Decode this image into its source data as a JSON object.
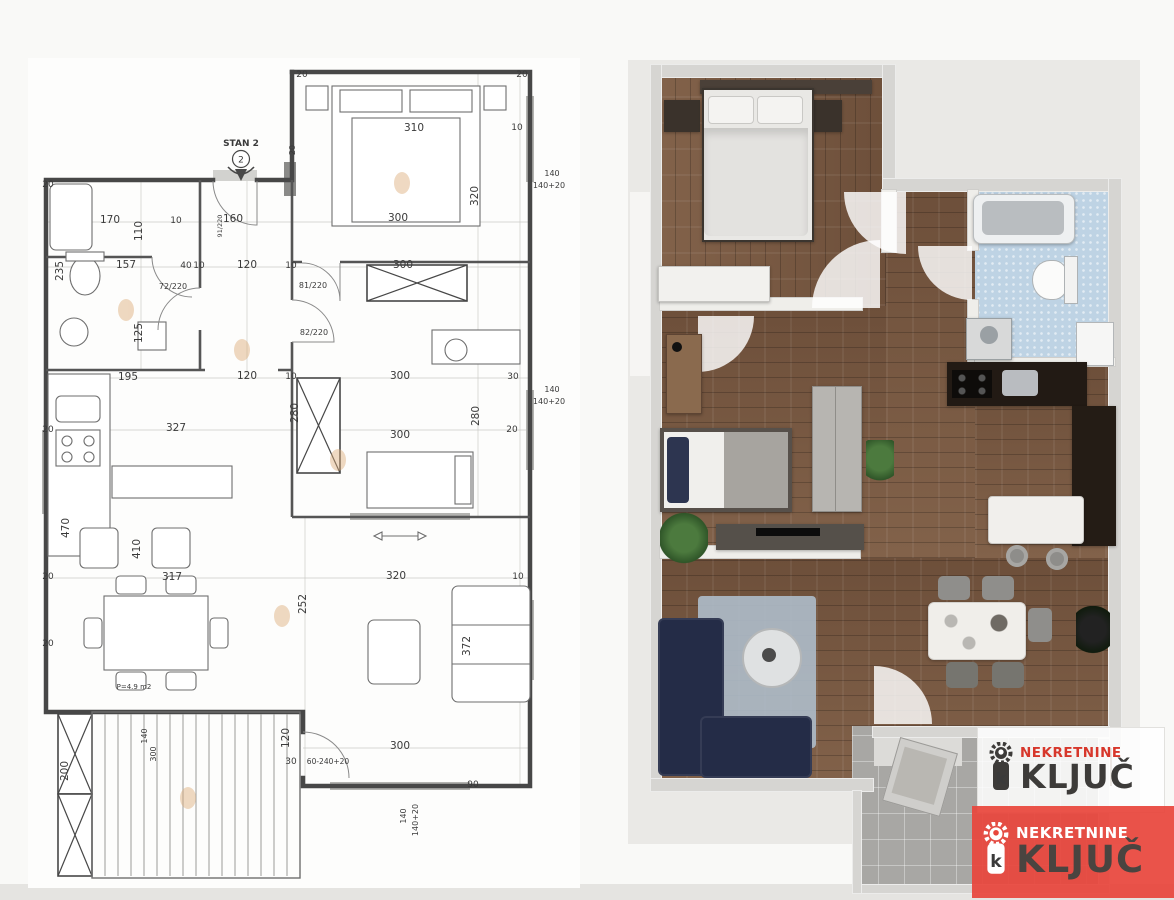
{
  "canvas": {
    "width": 1174,
    "height": 900
  },
  "theme": {
    "brand-red": "#d7372b",
    "brand-red-bg": "#e8473c",
    "logo-dark": "#3d3b39",
    "wood": "#7a5a42",
    "navy": "#242c47",
    "tile-blue": "#bed3e4",
    "line": "#474747"
  },
  "left_plan": {
    "entrance": {
      "label": "STAN 2",
      "number": "2"
    },
    "labels": [
      {
        "t": "310",
        "x": 414,
        "y": 131
      },
      {
        "t": "320",
        "x": 478,
        "y": 196,
        "r": -90
      },
      {
        "t": "20",
        "x": 302,
        "y": 77,
        "fs": 9
      },
      {
        "t": "20",
        "x": 522,
        "y": 77,
        "fs": 9
      },
      {
        "t": "10",
        "x": 517,
        "y": 130,
        "fs": 9
      },
      {
        "t": "20",
        "x": 295,
        "y": 150,
        "r": -90,
        "fs": 8
      },
      {
        "t": "170",
        "x": 110,
        "y": 223
      },
      {
        "t": "110",
        "x": 142,
        "y": 231,
        "r": -90
      },
      {
        "t": "10",
        "x": 176,
        "y": 223,
        "fs": 9
      },
      {
        "t": "91/220",
        "x": 222,
        "y": 226,
        "r": -90,
        "fs": 6.5
      },
      {
        "t": "160",
        "x": 233,
        "y": 222
      },
      {
        "t": "300",
        "x": 398,
        "y": 221
      },
      {
        "t": "20",
        "x": 48,
        "y": 187,
        "fs": 9
      },
      {
        "t": "235",
        "x": 63,
        "y": 271,
        "r": -90
      },
      {
        "t": "157",
        "x": 126,
        "y": 268
      },
      {
        "t": "40",
        "x": 186,
        "y": 268,
        "fs": 9
      },
      {
        "t": "10",
        "x": 199,
        "y": 268,
        "fs": 9
      },
      {
        "t": "120",
        "x": 247,
        "y": 268
      },
      {
        "t": "10",
        "x": 291,
        "y": 268,
        "fs": 9
      },
      {
        "t": "72/220",
        "x": 173,
        "y": 289,
        "fs": 8
      },
      {
        "t": "300",
        "x": 403,
        "y": 268
      },
      {
        "t": "81/220",
        "x": 313,
        "y": 288,
        "fs": 8
      },
      {
        "t": "82/220",
        "x": 314,
        "y": 335,
        "fs": 8
      },
      {
        "t": "125",
        "x": 142,
        "y": 333,
        "r": -90
      },
      {
        "t": "195",
        "x": 128,
        "y": 380
      },
      {
        "t": "120",
        "x": 247,
        "y": 379
      },
      {
        "t": "10",
        "x": 291,
        "y": 379,
        "fs": 9
      },
      {
        "t": "300",
        "x": 400,
        "y": 379
      },
      {
        "t": "30",
        "x": 513,
        "y": 379,
        "fs": 9
      },
      {
        "t": "280",
        "x": 479,
        "y": 416,
        "r": -90
      },
      {
        "t": "280",
        "x": 298,
        "y": 413,
        "r": -90
      },
      {
        "t": "327",
        "x": 176,
        "y": 431
      },
      {
        "t": "20",
        "x": 48,
        "y": 432,
        "fs": 9
      },
      {
        "t": "20",
        "x": 512,
        "y": 432,
        "fs": 9
      },
      {
        "t": "300",
        "x": 400,
        "y": 438
      },
      {
        "t": "140",
        "x": 552,
        "y": 176,
        "fs": 8
      },
      {
        "t": "140+20",
        "x": 549,
        "y": 188,
        "fs": 8
      },
      {
        "t": "140",
        "x": 552,
        "y": 392,
        "fs": 8
      },
      {
        "t": "140+20",
        "x": 549,
        "y": 404,
        "fs": 8
      },
      {
        "t": "470",
        "x": 69,
        "y": 528,
        "r": -90
      },
      {
        "t": "410",
        "x": 140,
        "y": 549,
        "r": -90
      },
      {
        "t": "317",
        "x": 172,
        "y": 580
      },
      {
        "t": "320",
        "x": 396,
        "y": 579
      },
      {
        "t": "10",
        "x": 518,
        "y": 579,
        "fs": 9
      },
      {
        "t": "20",
        "x": 48,
        "y": 579,
        "fs": 9
      },
      {
        "t": "252",
        "x": 306,
        "y": 604,
        "r": -90
      },
      {
        "t": "372",
        "x": 470,
        "y": 646,
        "r": -90
      },
      {
        "t": "20",
        "x": 48,
        "y": 646,
        "fs": 9
      },
      {
        "t": "P=4.9 m2",
        "x": 134,
        "y": 689,
        "fs": 7
      },
      {
        "t": "200",
        "x": 68,
        "y": 771,
        "r": -90
      },
      {
        "t": "140",
        "x": 147,
        "y": 736,
        "r": -90,
        "fs": 8
      },
      {
        "t": "300",
        "x": 156,
        "y": 754,
        "r": -90,
        "fs": 8
      },
      {
        "t": "120",
        "x": 289,
        "y": 738,
        "r": -90
      },
      {
        "t": "30",
        "x": 291,
        "y": 764,
        "fs": 9
      },
      {
        "t": "60-240+20",
        "x": 328,
        "y": 764,
        "fs": 7.5
      },
      {
        "t": "300",
        "x": 400,
        "y": 749
      },
      {
        "t": "90",
        "x": 473,
        "y": 787,
        "fs": 9
      },
      {
        "t": "140",
        "x": 406,
        "y": 816,
        "r": -90,
        "fs": 8
      },
      {
        "t": "140+20",
        "x": 418,
        "y": 820,
        "r": -90,
        "fs": 8
      }
    ]
  },
  "watermark": {
    "line1": "NEKRETNINE",
    "line2": "KLJUČ"
  }
}
